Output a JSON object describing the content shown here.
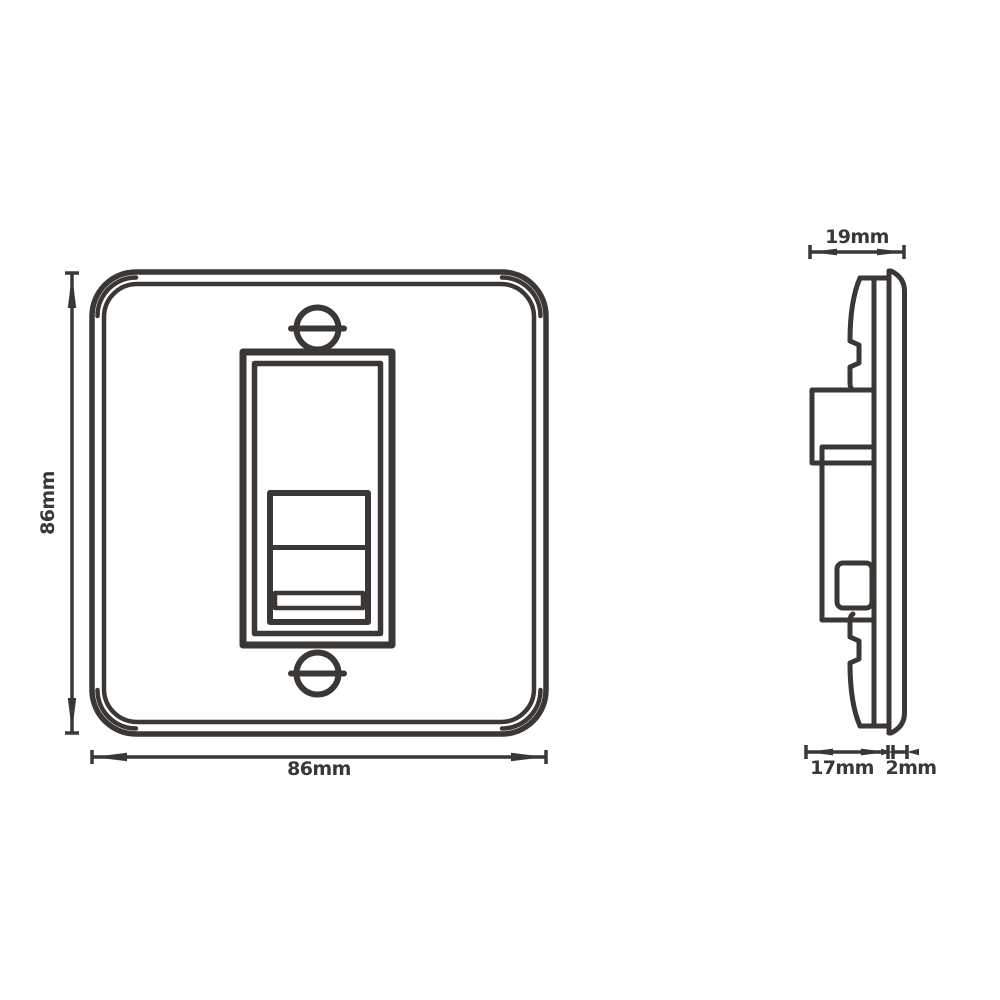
{
  "drawing": {
    "background": "#ffffff",
    "line_color": "#3b3734",
    "front_view": {
      "height_label": "86mm",
      "width_label": "86mm"
    },
    "side_view": {
      "total_depth_label": "19mm",
      "mechanism_depth_label": "17mm",
      "plate_thickness_label": "2mm"
    }
  }
}
